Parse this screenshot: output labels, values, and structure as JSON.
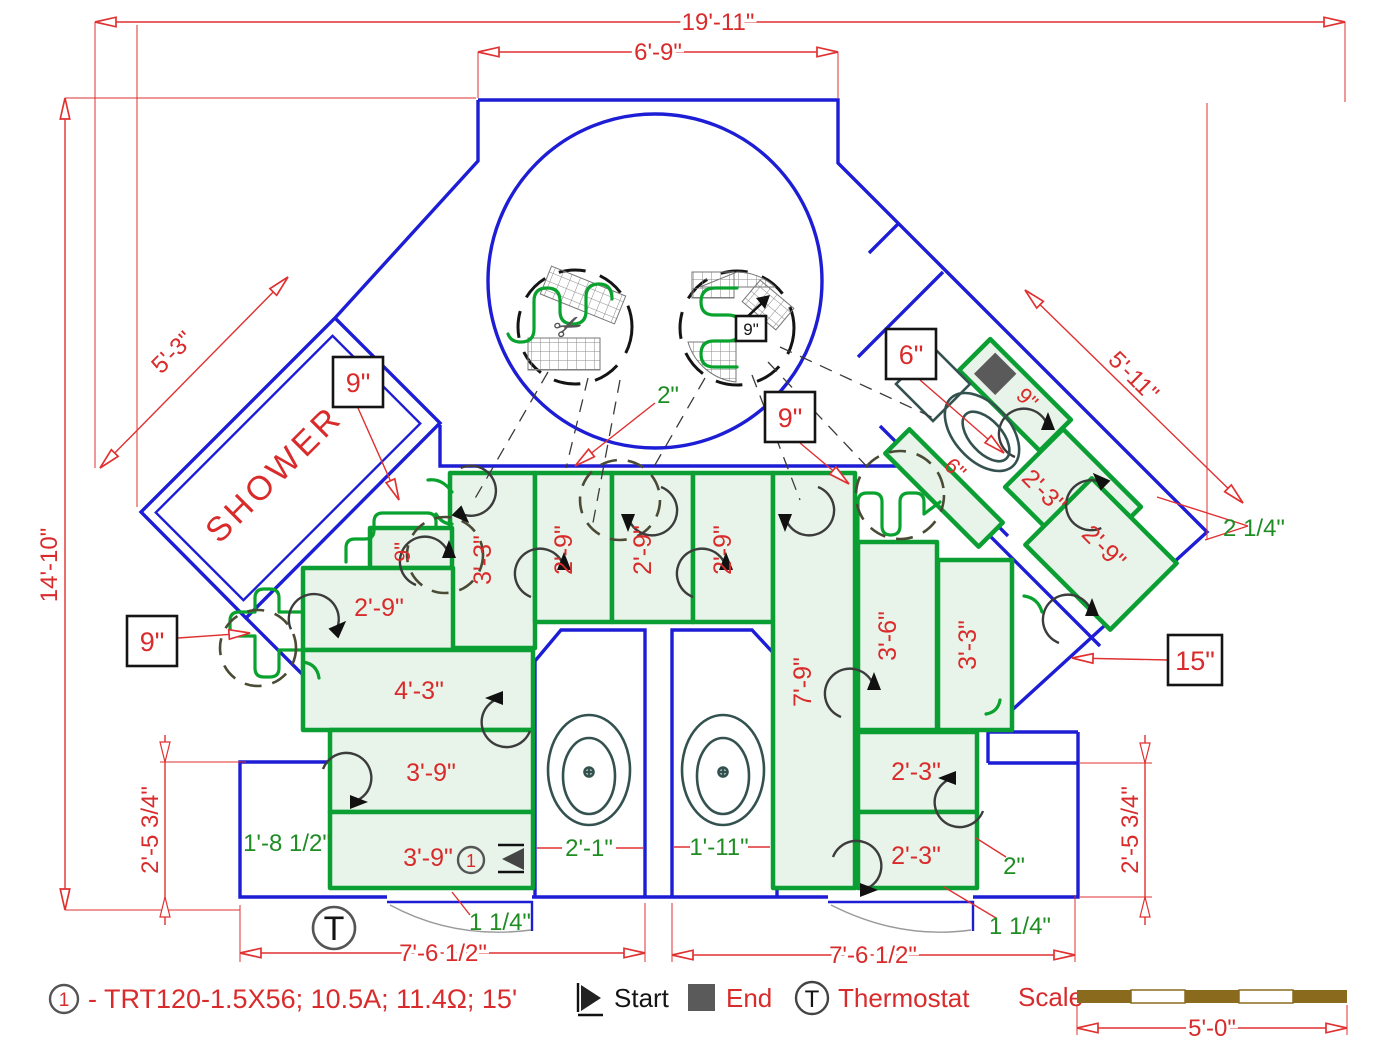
{
  "dimensions": {
    "top_overall": "19'-11\"",
    "top_alcove": "6'-9\"",
    "left_overall": "14'-10\"",
    "shower_side": "5'-3\"",
    "wing_side": "5'-11\"",
    "bottom_left": "7'-6 1/2\"",
    "bottom_right": "7'-6 1/2\"",
    "left_lower": "2'-5 3/4\"",
    "right_lower": "2'-5 3/4\"",
    "scale_length": "5'-0\""
  },
  "clearances": {
    "top_gap": "2\"",
    "corner_gap": "2 1/4\"",
    "niche_width": "1'-8 1/2\"",
    "left_stub": "2'-1\"",
    "right_stub": "1'-11\"",
    "door_left": "1 1/4\"",
    "door_right": "1 1/4\"",
    "right_gap": "2\""
  },
  "callouts": {
    "spacing_9": "9\"",
    "spacing_6": "6\"",
    "spacing_15": "15\"",
    "detail_9": "9\""
  },
  "mats": {
    "w3_3": "3'-3\"",
    "w2_9": "2'-9\"",
    "w7_9": "7'-9\"",
    "w3_6": "3'-6\"",
    "w4_3": "4'-3\"",
    "w3_9": "3'-9\"",
    "w2_3": "2'-3\"",
    "w9": "9\"",
    "w6": "6\""
  },
  "rooms": {
    "shower": "SHOWER"
  },
  "legend": {
    "circuit": "1",
    "spec": "- TRT120-1.5X56; 10.5A; 11.4Ω; 15'",
    "start": "Start",
    "end": "End",
    "thermostat": "Thermostat",
    "t": "T",
    "scale_title": "Scale"
  },
  "colors": {
    "wall_blue": "#1d1dd6",
    "mat_green": "#0a9e33",
    "mat_fill": "#e8f4ea",
    "dim_red": "#e03030",
    "note_green": "#1f8c24",
    "scale_brown": "#8a6b1e"
  }
}
